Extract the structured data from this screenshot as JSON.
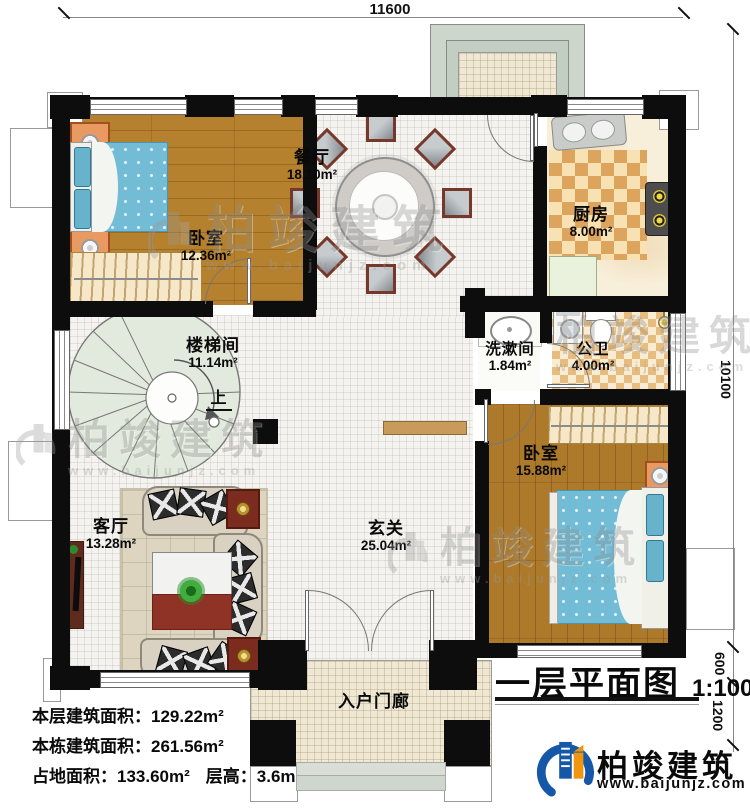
{
  "plan": {
    "dims": {
      "top": "11600",
      "right_total": "10100",
      "right_seg1": "600",
      "right_seg2": "1200"
    },
    "rooms": {
      "bedroom1": {
        "name": "卧室",
        "area": "12.36m²"
      },
      "dining": {
        "name": "餐厅",
        "area": "18.10m²"
      },
      "kitchen": {
        "name": "厨房",
        "area": "8.00m²"
      },
      "stairwell": {
        "name": "楼梯间",
        "area": "11.14m²",
        "up": "上"
      },
      "washroom": {
        "name": "洗漱间",
        "area": "1.84m²"
      },
      "bathroom": {
        "name": "公卫",
        "area": "4.00m²"
      },
      "bedroom2": {
        "name": "卧室",
        "area": "15.88m²"
      },
      "living": {
        "name": "客厅",
        "area": "13.28m²"
      },
      "foyer": {
        "name": "玄关",
        "area": "25.04m²"
      },
      "porch": {
        "name": "入户门廊"
      }
    }
  },
  "stats": {
    "floor_area_label": "本层建筑面积：",
    "floor_area": "129.22m²",
    "building_area_label": "本栋建筑面积：",
    "building_area": "261.56m²",
    "footprint_label": "占地面积：",
    "footprint": "133.60m²",
    "height_label": "层高：",
    "height": "3.6m"
  },
  "title": {
    "text": "一层平面图",
    "scale": "1:100"
  },
  "brand": {
    "name": "柏竣建筑",
    "url": "www.baijunjz.com"
  },
  "watermark": {
    "name": "柏竣建筑",
    "url": "www.baijunjz.com"
  },
  "colors": {
    "wall": "#0d0d0d",
    "wood_floor": "#b5812e",
    "wood_floor_dark": "#ad792a",
    "tile_floor": "#f4f3ef",
    "bed_blue": "#72bcd6",
    "kitchen_check": "#dda45e",
    "brand_blue": "#1558a8",
    "brand_orange": "#f0950f"
  }
}
